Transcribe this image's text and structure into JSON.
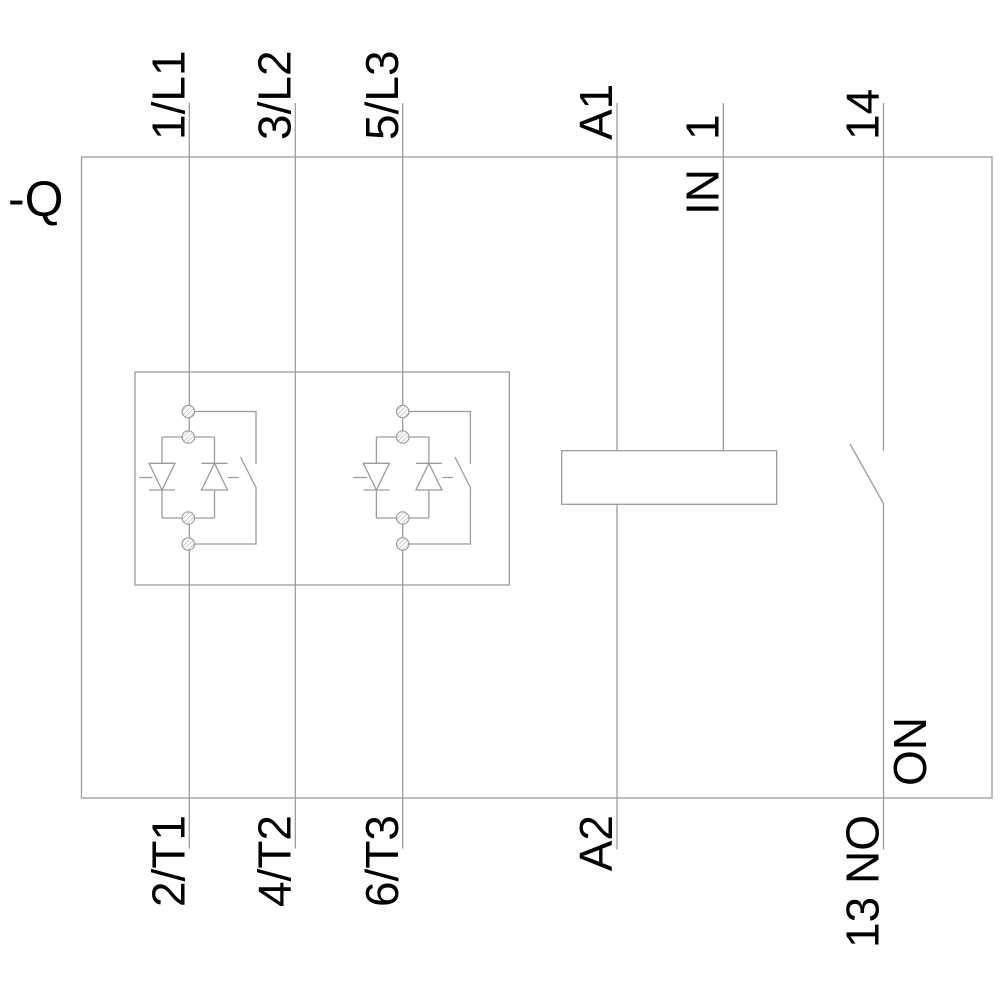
{
  "diagram": {
    "device_label": "-Q",
    "top_terminals": {
      "l1": "1/L1",
      "l2": "3/L2",
      "l3": "5/L3",
      "a1": "A1",
      "control_in": "1",
      "aux_out": "14"
    },
    "bottom_terminals": {
      "t1": "2/T1",
      "t2": "4/T2",
      "t3": "6/T3",
      "a2": "A2",
      "aux_in": "13 NO"
    },
    "internal_labels": {
      "control_input": "IN",
      "aux_contact_function": "ON"
    },
    "colors": {
      "line": "#9c9c9c",
      "text": "#000000",
      "background": "#ffffff"
    }
  }
}
